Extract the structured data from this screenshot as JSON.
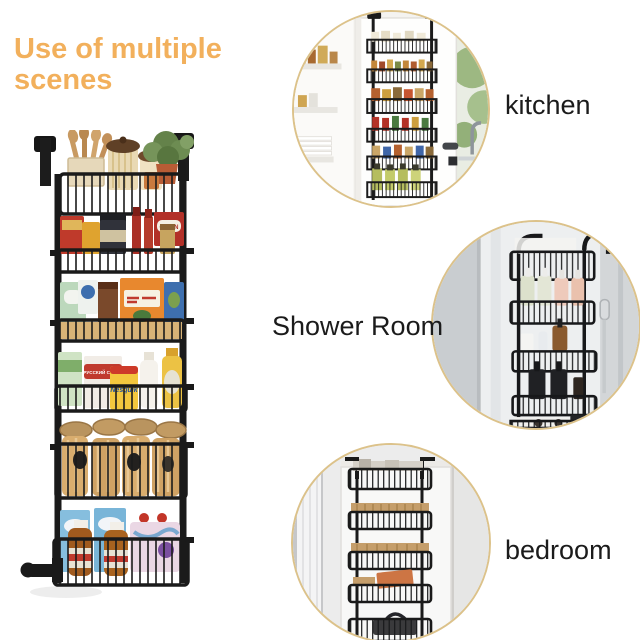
{
  "title": {
    "text": "Use of multiple scenes"
  },
  "scenes": [
    {
      "id": "kitchen",
      "label": "kitchen"
    },
    {
      "id": "shower-room",
      "label": "Shower Room"
    },
    {
      "id": "bedroom",
      "label": "bedroom"
    }
  ],
  "product": {
    "package_labels": {
      "nesquik": "Nesquik",
      "sugar_box": "РУССКИЙ САХАР",
      "canin_box": "CANIN"
    }
  },
  "colors": {
    "background": "#FFFFFF",
    "title_accent": "#F2B05C",
    "label_text": "#1B1B1B",
    "circle_ring": "#DCC28A",
    "rack_metal": "#1A1A1A"
  }
}
